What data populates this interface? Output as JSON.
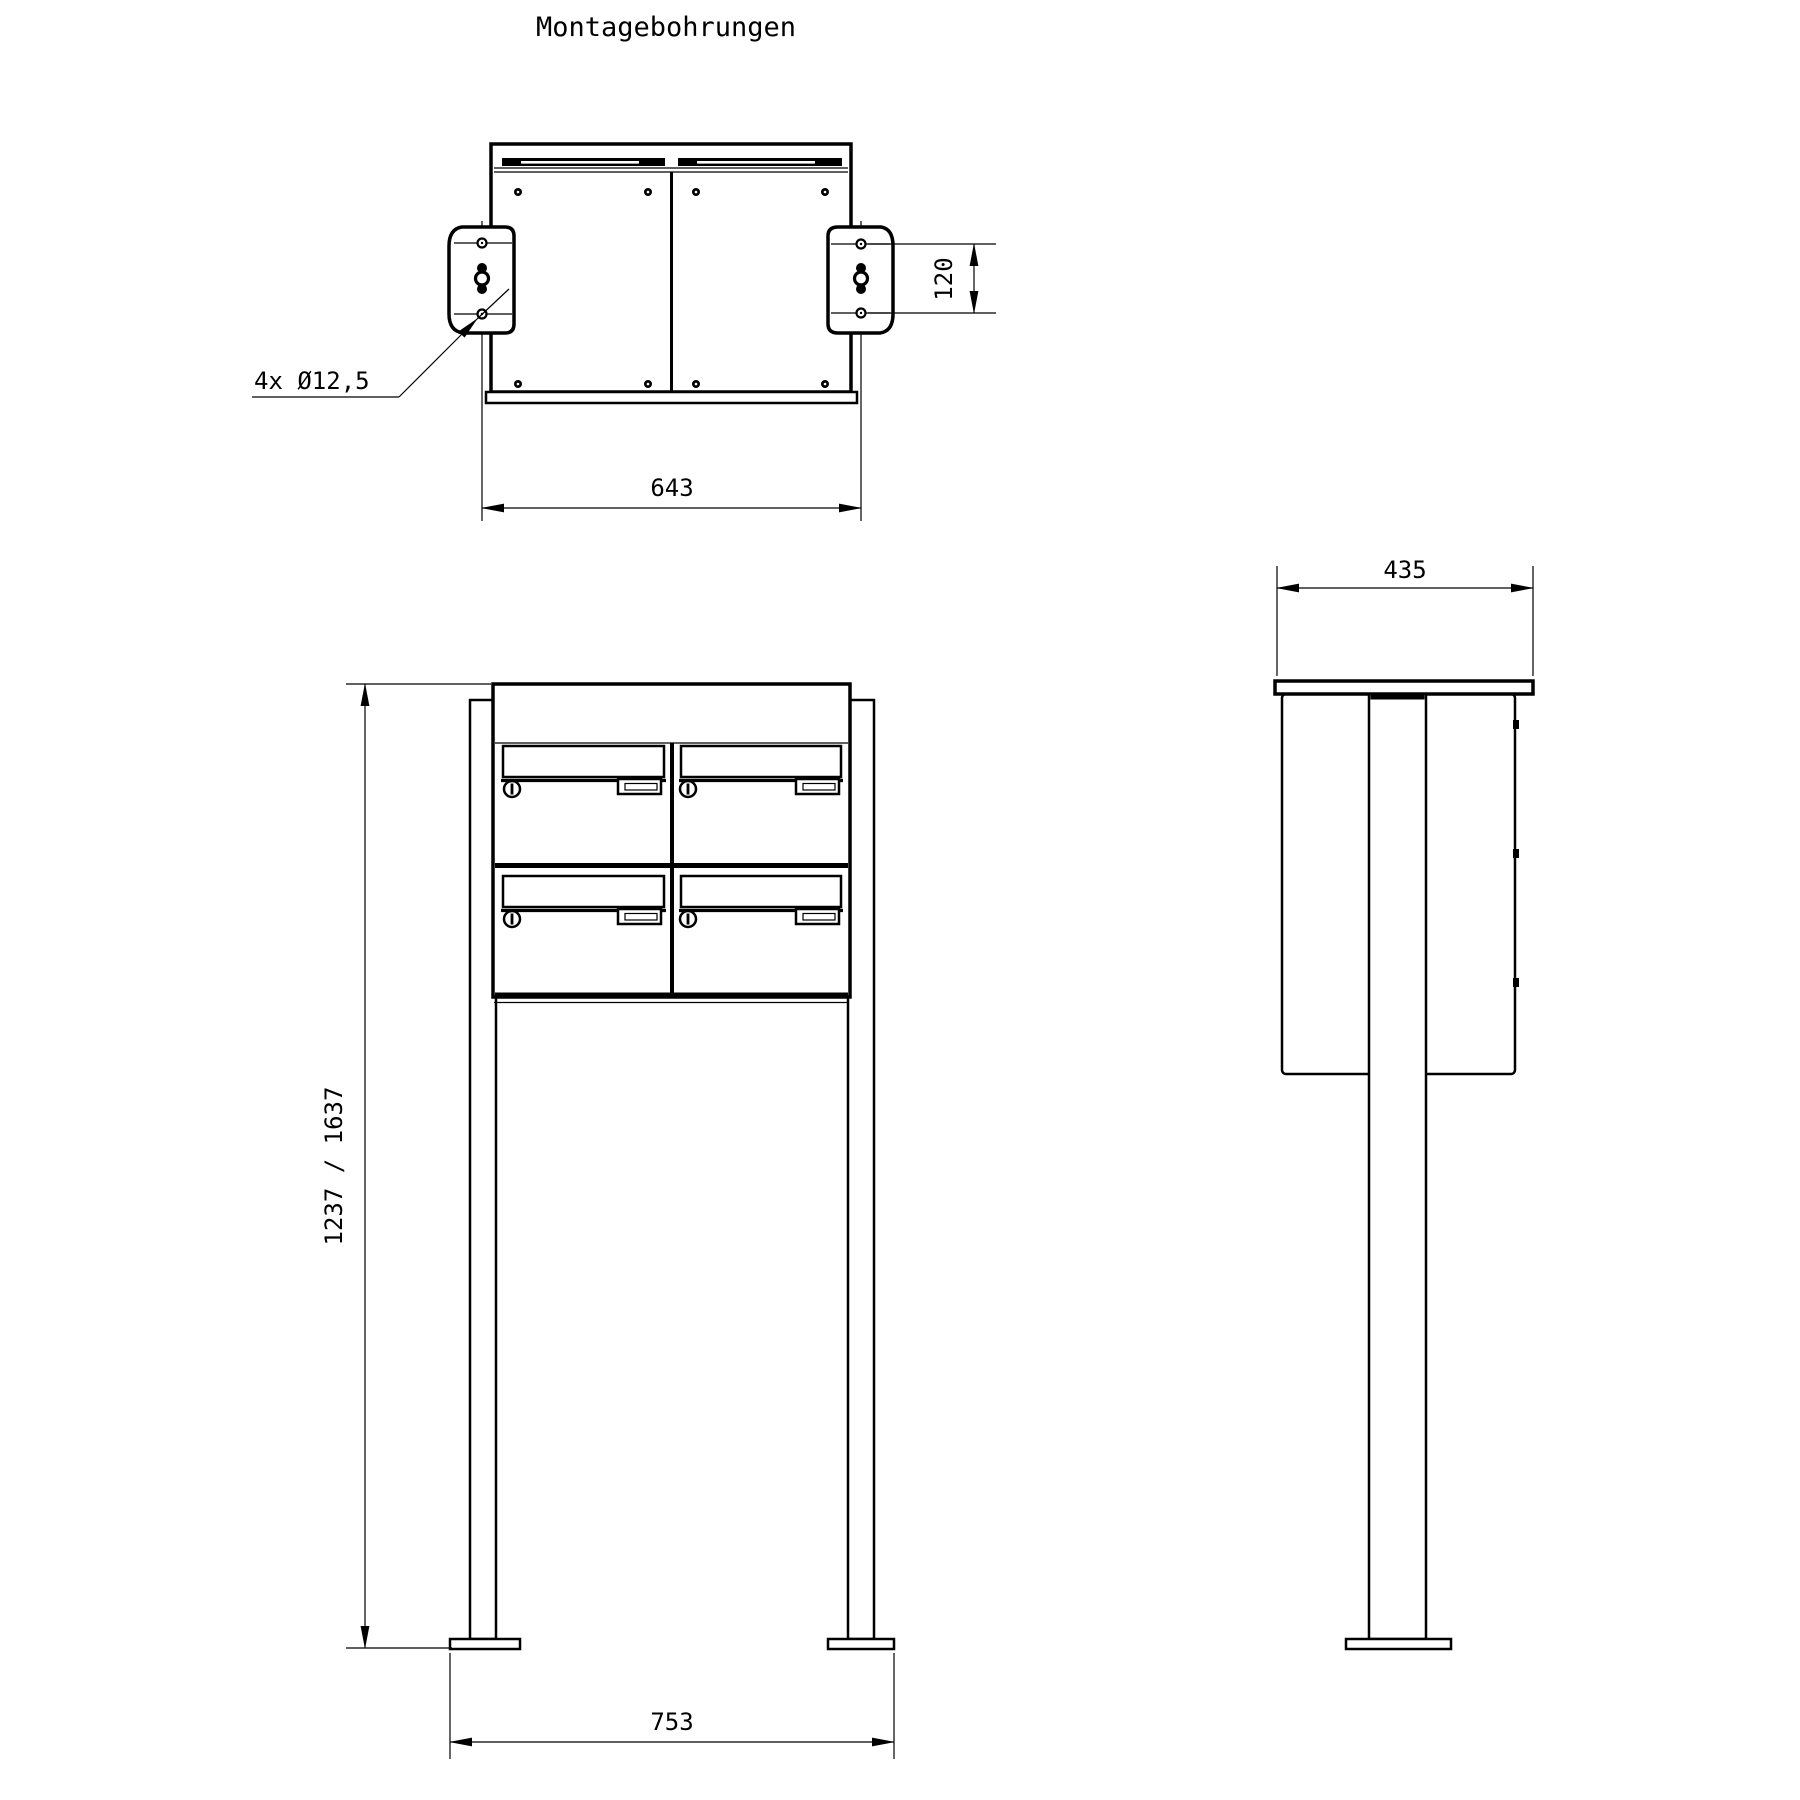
{
  "drawing": {
    "title": "Montagebohrungen",
    "dimensions": {
      "top_width": "643",
      "bracket_hole_spacing": "120",
      "drill_note": "4x Ø12,5",
      "depth": "435",
      "height_range": "1237 / 1637",
      "base_spacing": "753"
    },
    "colors": {
      "line": "#000000",
      "background": "#ffffff"
    }
  }
}
